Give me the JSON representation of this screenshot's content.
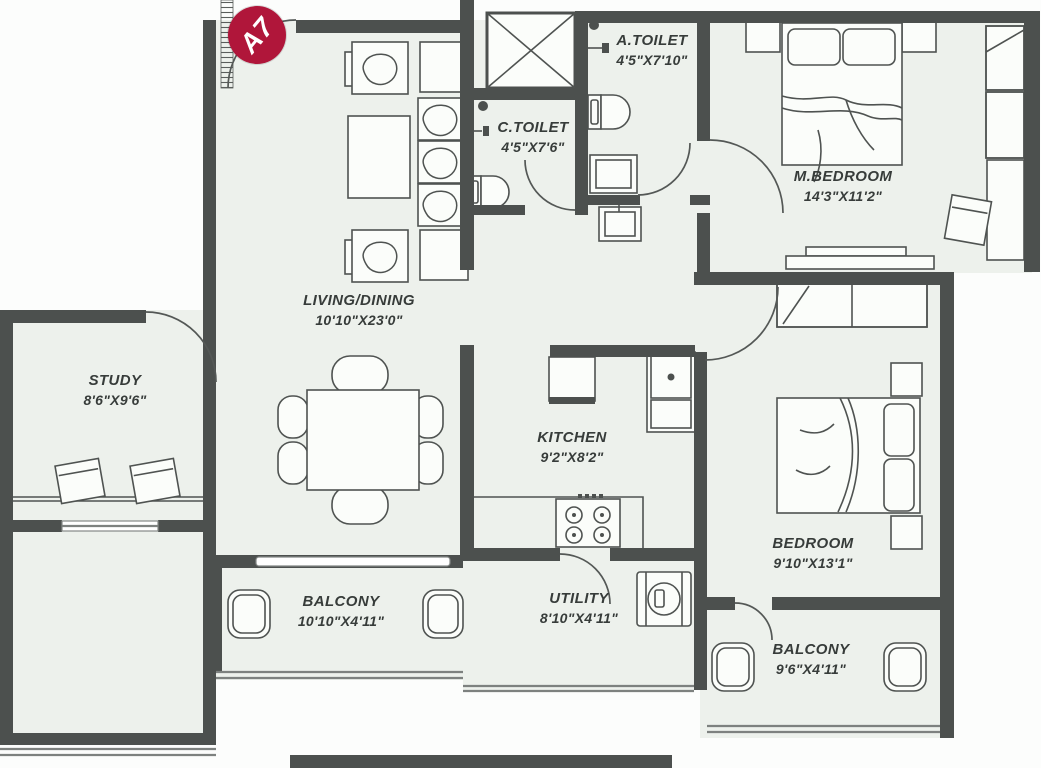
{
  "plan": {
    "unit_label": "A7",
    "rooms": [
      {
        "id": "a-toilet",
        "name": "A.TOILET",
        "size": "4'5\"X7'10\""
      },
      {
        "id": "c-toilet",
        "name": "C.TOILET",
        "size": "4'5\"X7'6\""
      },
      {
        "id": "m-bedroom",
        "name": "M.BEDROOM",
        "size": "14'3\"X11'2\""
      },
      {
        "id": "living-dining",
        "name": "LIVING/DINING",
        "size": "10'10\"X23'0\""
      },
      {
        "id": "study",
        "name": "STUDY",
        "size": "8'6\"X9'6\""
      },
      {
        "id": "kitchen",
        "name": "KITCHEN",
        "size": "9'2\"X8'2\""
      },
      {
        "id": "bedroom",
        "name": "BEDROOM",
        "size": "9'10\"X13'1\""
      },
      {
        "id": "balcony-left",
        "name": "BALCONY",
        "size": "10'10\"X4'11\""
      },
      {
        "id": "utility",
        "name": "UTILITY",
        "size": "8'10\"X4'11\""
      },
      {
        "id": "balcony-right",
        "name": "BALCONY",
        "size": "9'6\"X4'11\""
      }
    ],
    "colors": {
      "wall": "#4c504e",
      "floor": "#edf1ec",
      "badge": "#b0163a",
      "line": "#4f5351"
    }
  }
}
